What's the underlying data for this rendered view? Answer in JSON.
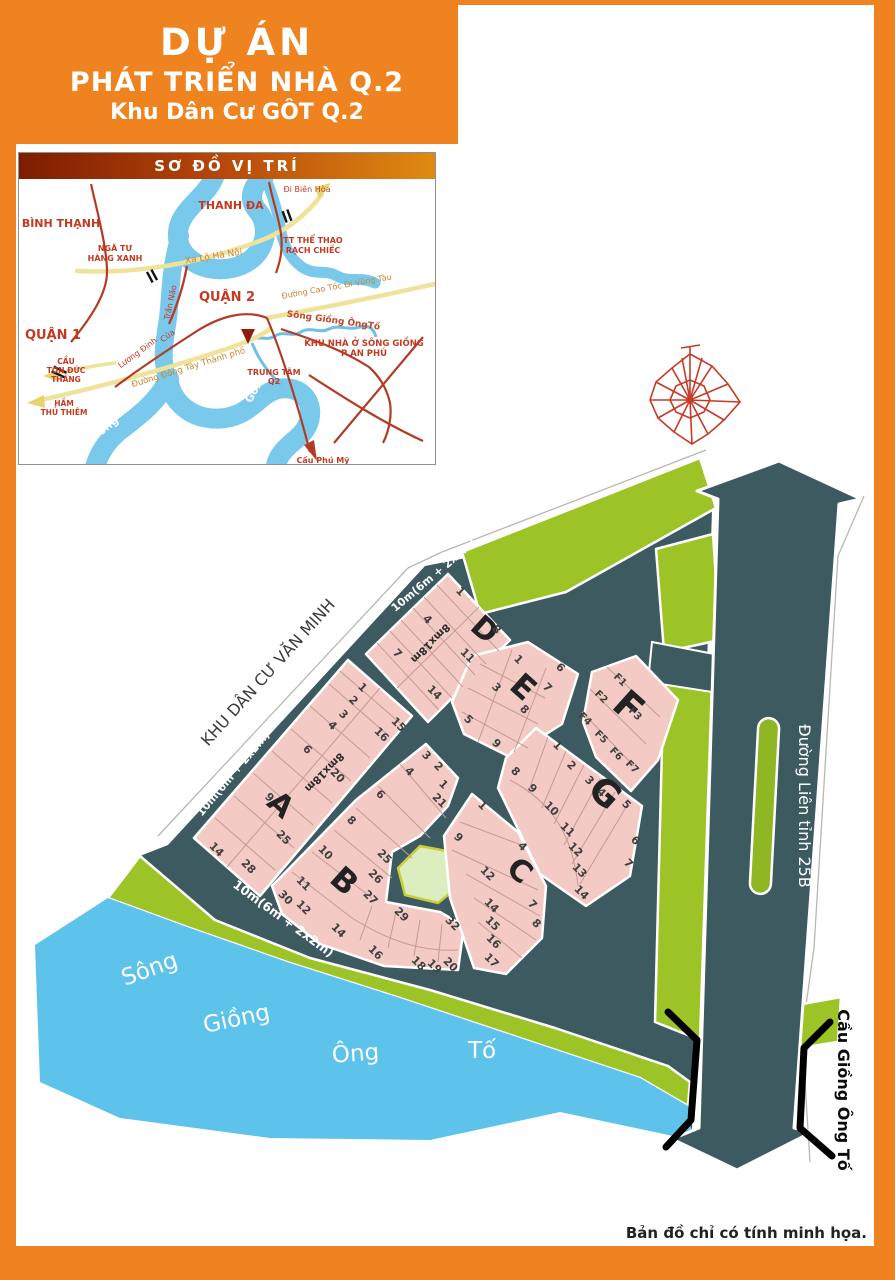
{
  "header": {
    "line1": "DỰ ÁN",
    "line2": "PHÁT TRIỂN NHÀ Q.2",
    "line3": "Khu Dân Cư GÔT Q.2"
  },
  "colors": {
    "frame_orange": "#ef831f",
    "road_dark": "#3d5a61",
    "parcel_pink": "#f3cbc4",
    "green_strip": "#9cc427",
    "river_blue": "#5ec3ea",
    "park_fill": "#dcedc0"
  },
  "location_map": {
    "title": "SƠ ĐỒ VỊ TRÍ",
    "labels": [
      {
        "t": "BÌNH THẠNH",
        "x": 42,
        "y": 48,
        "s": 11,
        "w": 700
      },
      {
        "t": "THANH ĐA",
        "x": 212,
        "y": 30,
        "s": 11,
        "w": 700
      },
      {
        "t": "Đi Biên Hòa",
        "x": 288,
        "y": 13,
        "s": 8
      },
      {
        "t": "NGÃ TƯ",
        "x": 96,
        "y": 72,
        "s": 8,
        "w": 700
      },
      {
        "t": "HÀNG XANH",
        "x": 96,
        "y": 82,
        "s": 8,
        "w": 700
      },
      {
        "t": "Xa Lộ Hà Nội",
        "x": 195,
        "y": 80,
        "s": 9,
        "c": "#c8862c",
        "r": -9
      },
      {
        "t": "TT THỂ THAO",
        "x": 294,
        "y": 64,
        "s": 8,
        "w": 700
      },
      {
        "t": "RẠCH CHIẾC",
        "x": 294,
        "y": 74,
        "s": 8,
        "w": 700
      },
      {
        "t": "QUẬN 2",
        "x": 208,
        "y": 122,
        "s": 13,
        "w": 700
      },
      {
        "t": "Đường Cao Tốc Đi Vũng Tàu",
        "x": 318,
        "y": 110,
        "s": 8,
        "c": "#c8862c",
        "r": -10
      },
      {
        "t": "QUẬN 1",
        "x": 34,
        "y": 160,
        "s": 13,
        "w": 700
      },
      {
        "t": "CẦU",
        "x": 47,
        "y": 185,
        "s": 7.5,
        "w": 700
      },
      {
        "t": "TÔN ĐỨC",
        "x": 47,
        "y": 194,
        "s": 7.5,
        "w": 700
      },
      {
        "t": "THẮNG",
        "x": 47,
        "y": 203,
        "s": 7.5,
        "w": 700
      },
      {
        "t": "HẦM",
        "x": 45,
        "y": 227,
        "s": 7.5,
        "w": 700
      },
      {
        "t": "THỦ THIÊM",
        "x": 45,
        "y": 236,
        "s": 7.5,
        "w": 700
      },
      {
        "t": "Trần Não",
        "x": 154,
        "y": 124,
        "s": 8,
        "r": -78
      },
      {
        "t": "Của",
        "x": 150,
        "y": 159,
        "s": 8,
        "r": -36
      },
      {
        "t": "Lương Định",
        "x": 120,
        "y": 176,
        "s": 8,
        "r": -36
      },
      {
        "t": "Đường Đông Tây Thành phố",
        "x": 170,
        "y": 191,
        "s": 8.5,
        "c": "#c8862c",
        "r": -17
      },
      {
        "t": "Sông Giồng ÔngTố",
        "x": 314,
        "y": 144,
        "s": 9,
        "c": "#c04526",
        "r": 8,
        "w": 700
      },
      {
        "t": "KHU NHÀ Ở SÔNG GIỒNG",
        "x": 345,
        "y": 167,
        "s": 8.5,
        "w": 700
      },
      {
        "t": "P AN PHÚ",
        "x": 345,
        "y": 177,
        "s": 8.5,
        "w": 700
      },
      {
        "t": "TRUNG TÂM",
        "x": 255,
        "y": 196,
        "s": 8,
        "w": 700
      },
      {
        "t": "Q2",
        "x": 255,
        "y": 205,
        "s": 8,
        "w": 700
      },
      {
        "t": "Cầu Phú Mỹ",
        "x": 304,
        "y": 284,
        "s": 8,
        "w": 700
      },
      {
        "t": "Sông",
        "x": 88,
        "y": 252,
        "s": 11,
        "c": "#ffffff",
        "r": -38,
        "w": 700
      },
      {
        "t": "Sài",
        "x": 110,
        "y": 272,
        "s": 11,
        "c": "#ffffff",
        "r": -15,
        "w": 700
      },
      {
        "t": "Gòn",
        "x": 238,
        "y": 214,
        "s": 11,
        "c": "#ffffff",
        "r": -60,
        "w": 700
      }
    ]
  },
  "site_plan": {
    "blocks": [
      {
        "name": "A",
        "letter": {
          "t": "A",
          "x": 274,
          "y": 812,
          "s": 30,
          "r": 42
        },
        "plots": [
          {
            "t": "1",
            "x": 360,
            "y": 690
          },
          {
            "t": "2",
            "x": 351,
            "y": 703
          },
          {
            "t": "3",
            "x": 341,
            "y": 717
          },
          {
            "t": "4",
            "x": 330,
            "y": 728
          },
          {
            "t": "6",
            "x": 305,
            "y": 752
          },
          {
            "t": "9",
            "x": 267,
            "y": 800
          },
          {
            "t": "14",
            "x": 214,
            "y": 852
          },
          {
            "t": "15",
            "x": 396,
            "y": 727
          },
          {
            "t": "16",
            "x": 379,
            "y": 737
          },
          {
            "t": "20",
            "x": 335,
            "y": 778
          },
          {
            "t": "25",
            "x": 281,
            "y": 840
          },
          {
            "t": "28",
            "x": 246,
            "y": 869
          }
        ]
      },
      {
        "name": "B",
        "letter": {
          "t": "B",
          "x": 337,
          "y": 889,
          "s": 32,
          "r": 42
        },
        "plots": [
          {
            "t": "3",
            "x": 424,
            "y": 758
          },
          {
            "t": "2",
            "x": 436,
            "y": 769
          },
          {
            "t": "1",
            "x": 441,
            "y": 787
          },
          {
            "t": "21",
            "x": 437,
            "y": 803
          },
          {
            "t": "4",
            "x": 407,
            "y": 774
          },
          {
            "t": "6",
            "x": 378,
            "y": 797
          },
          {
            "t": "8",
            "x": 349,
            "y": 823
          },
          {
            "t": "10",
            "x": 323,
            "y": 855
          },
          {
            "t": "11",
            "x": 301,
            "y": 886
          },
          {
            "t": "30",
            "x": 283,
            "y": 900
          },
          {
            "t": "12",
            "x": 301,
            "y": 910
          },
          {
            "t": "14",
            "x": 336,
            "y": 933
          },
          {
            "t": "16",
            "x": 373,
            "y": 955
          },
          {
            "t": "18",
            "x": 416,
            "y": 966
          },
          {
            "t": "19",
            "x": 432,
            "y": 969
          },
          {
            "t": "20",
            "x": 448,
            "y": 967
          },
          {
            "t": "25",
            "x": 382,
            "y": 859
          },
          {
            "t": "26",
            "x": 373,
            "y": 879
          },
          {
            "t": "27",
            "x": 368,
            "y": 900
          },
          {
            "t": "29",
            "x": 399,
            "y": 917
          },
          {
            "t": "32",
            "x": 450,
            "y": 926
          }
        ]
      },
      {
        "name": "C",
        "letter": {
          "t": "C",
          "x": 513,
          "y": 878,
          "s": 30,
          "r": 42
        },
        "plots": [
          {
            "t": "1",
            "x": 480,
            "y": 808
          },
          {
            "t": "9",
            "x": 456,
            "y": 840
          },
          {
            "t": "4",
            "x": 520,
            "y": 849
          },
          {
            "t": "12",
            "x": 485,
            "y": 876
          },
          {
            "t": "7",
            "x": 530,
            "y": 907
          },
          {
            "t": "8",
            "x": 534,
            "y": 926
          },
          {
            "t": "14",
            "x": 489,
            "y": 908
          },
          {
            "t": "15",
            "x": 490,
            "y": 926
          },
          {
            "t": "16",
            "x": 491,
            "y": 944
          },
          {
            "t": "17",
            "x": 489,
            "y": 963
          }
        ]
      },
      {
        "name": "D",
        "letter": {
          "t": "D",
          "x": 478,
          "y": 637,
          "s": 30,
          "r": 42
        },
        "plots": [
          {
            "t": "1",
            "x": 458,
            "y": 594
          },
          {
            "t": "4",
            "x": 425,
            "y": 622
          },
          {
            "t": "7",
            "x": 395,
            "y": 656
          },
          {
            "t": "8",
            "x": 494,
            "y": 632
          },
          {
            "t": "11",
            "x": 465,
            "y": 658
          },
          {
            "t": "14",
            "x": 432,
            "y": 695
          }
        ]
      },
      {
        "name": "E",
        "letter": {
          "t": "E",
          "x": 516,
          "y": 695,
          "s": 32,
          "r": 42
        },
        "plots": [
          {
            "t": "1",
            "x": 516,
            "y": 662
          },
          {
            "t": "6",
            "x": 558,
            "y": 670
          },
          {
            "t": "3",
            "x": 494,
            "y": 690
          },
          {
            "t": "7",
            "x": 545,
            "y": 690
          },
          {
            "t": "8",
            "x": 522,
            "y": 712
          },
          {
            "t": "5",
            "x": 466,
            "y": 722
          },
          {
            "t": "9",
            "x": 494,
            "y": 746
          }
        ]
      },
      {
        "name": "F",
        "letter": {
          "t": "F",
          "x": 620,
          "y": 716,
          "s": 38,
          "r": 42
        },
        "plots": [
          {
            "t": "F1",
            "x": 618,
            "y": 682,
            "s": 10
          },
          {
            "t": "F2",
            "x": 599,
            "y": 699,
            "s": 10
          },
          {
            "t": "F3",
            "x": 633,
            "y": 716,
            "s": 10
          },
          {
            "t": "F4",
            "x": 583,
            "y": 721,
            "s": 10
          },
          {
            "t": "F5",
            "x": 599,
            "y": 739,
            "s": 10
          },
          {
            "t": "F6",
            "x": 614,
            "y": 756,
            "s": 10
          },
          {
            "t": "F7",
            "x": 630,
            "y": 769,
            "s": 10
          }
        ]
      },
      {
        "name": "G",
        "letter": {
          "t": "G",
          "x": 597,
          "y": 802,
          "s": 36,
          "r": 42
        },
        "plots": [
          {
            "t": "1",
            "x": 555,
            "y": 748
          },
          {
            "t": "2",
            "x": 569,
            "y": 768
          },
          {
            "t": "3",
            "x": 587,
            "y": 783
          },
          {
            "t": "4",
            "x": 599,
            "y": 795
          },
          {
            "t": "5",
            "x": 624,
            "y": 807
          },
          {
            "t": "6",
            "x": 633,
            "y": 843
          },
          {
            "t": "7",
            "x": 626,
            "y": 866
          },
          {
            "t": "8",
            "x": 513,
            "y": 774
          },
          {
            "t": "9",
            "x": 530,
            "y": 791
          },
          {
            "t": "10",
            "x": 549,
            "y": 811
          },
          {
            "t": "11",
            "x": 565,
            "y": 832
          },
          {
            "t": "12",
            "x": 573,
            "y": 852
          },
          {
            "t": "13",
            "x": 577,
            "y": 873
          },
          {
            "t": "14",
            "x": 579,
            "y": 895
          }
        ]
      }
    ],
    "road_labels": [
      {
        "t": "10m(6m + 2x2m)",
        "x": 436,
        "y": 578,
        "s": 11,
        "r": -40,
        "c": "#ffffff",
        "w": 700
      },
      {
        "t": "10m(6m + 2x2m)",
        "x": 236,
        "y": 776,
        "s": 11,
        "r": -50,
        "c": "#ffffff",
        "w": 700
      },
      {
        "t": "10m(6m + 2x2m)",
        "x": 281,
        "y": 922,
        "s": 12.5,
        "r": 36,
        "c": "#ffffff",
        "w": 700
      },
      {
        "t": "8mx18m",
        "x": 428,
        "y": 641,
        "s": 10.5,
        "r": 135,
        "c": "#2a2a2a",
        "w": 700
      },
      {
        "t": "8mx18m",
        "x": 322,
        "y": 770,
        "s": 10.5,
        "r": 135,
        "c": "#2a2a2a",
        "w": 700
      },
      {
        "t": "Đường Liên tỉnh 25B",
        "x": 799,
        "y": 806,
        "s": 16,
        "r": 90,
        "c": "#ffffff",
        "w": 400
      }
    ],
    "annotations": [
      {
        "t": "KHU DÂN CƯ VĂN MINH",
        "x": 272,
        "y": 676,
        "s": 16,
        "r": -48,
        "c": "#3b3b3b",
        "w": 500
      },
      {
        "t": "Cầu Giồng Ông Tố",
        "x": 838,
        "y": 1090,
        "s": 16,
        "r": 90,
        "c": "#0c0c0c",
        "w": 700
      }
    ],
    "river_words": [
      {
        "t": "Sông",
        "x": 152,
        "y": 976,
        "s": 23,
        "r": -20,
        "c": "#ffffff"
      },
      {
        "t": "Giồng",
        "x": 238,
        "y": 1026,
        "s": 23,
        "r": -12,
        "c": "#ffffff"
      },
      {
        "t": "Ông",
        "x": 356,
        "y": 1061,
        "s": 23,
        "r": -4,
        "c": "#ffffff"
      },
      {
        "t": "Tố",
        "x": 482,
        "y": 1058,
        "s": 23,
        "r": 0,
        "c": "#ffffff"
      }
    ]
  },
  "footer": {
    "disclaimer": "Bản đồ chỉ có tính minh họa."
  }
}
